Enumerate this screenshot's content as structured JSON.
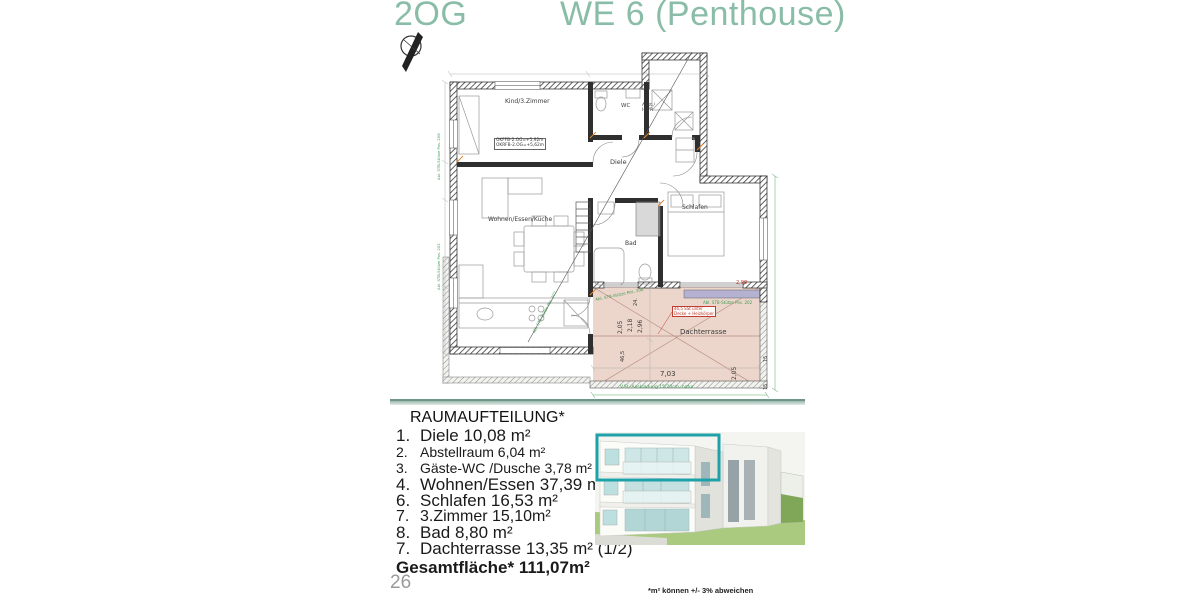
{
  "header": {
    "floor": "2OG",
    "unit": "WE 6 (Penthouse)"
  },
  "plan": {
    "rooms": {
      "kind": "Kind/3.Zimmer",
      "wc": "WC",
      "abst": "Abst./ HWR",
      "diele": "Diele",
      "wohnen": "Wohnen/Essen/Küche",
      "schlafen": "Schlafen",
      "bad": "Bad",
      "terrasse": "Dachterrasse"
    },
    "notes": {
      "level1": "OKFFB-2.OG=+5,92m",
      "level2": "OKRFB-2.OG=+5,62m",
      "red1": "46,5 SSt unter",
      "red2": "Decke + Heizkörper",
      "green_a": "Abl. STB-Stütze Pos. 208",
      "green_b": "Abl. STB-Stütze Pos. 202",
      "green_c": "V.St.-Auskladung 15/20cm, natur",
      "red_dim": "2,98"
    },
    "dims": {
      "w": "7,03",
      "a": "2,05",
      "b": "2,18",
      "c": "2,96",
      "d": "46,5",
      "e": "24.",
      "f": "2,05",
      "g": "15",
      "h": "15"
    }
  },
  "room_list": {
    "title": "RAUMAUFTEILUNG*",
    "items": [
      {
        "num": "1.",
        "text": "Diele 10,08 m²",
        "size": "lg"
      },
      {
        "num": "2.",
        "text": "Abstellraum 6,04 m²",
        "size": "sm"
      },
      {
        "num": "3.",
        "text": "Gäste-WC /Dusche 3,78 m²",
        "size": "sm"
      },
      {
        "num": "4.",
        "text": "Wohnen/Essen 37,39 m²",
        "size": "lg"
      },
      {
        "num": "6.",
        "text": "Schlafen 16,53 m²",
        "size": "lg"
      },
      {
        "num": "7.",
        "text": "3.Zimmer 15,10m²",
        "size": "md"
      },
      {
        "num": "8.",
        "text": "Bad 8,80 m²",
        "size": "lg"
      },
      {
        "num": "7.",
        "text": "Dachterrasse 13,35 m² (1/2)",
        "size": "lg"
      }
    ],
    "total": "Gesamtfläche* 111,07m²"
  },
  "footer": {
    "page_number": "26",
    "disclaimer": "*m² können +/- 3% abweichen"
  }
}
